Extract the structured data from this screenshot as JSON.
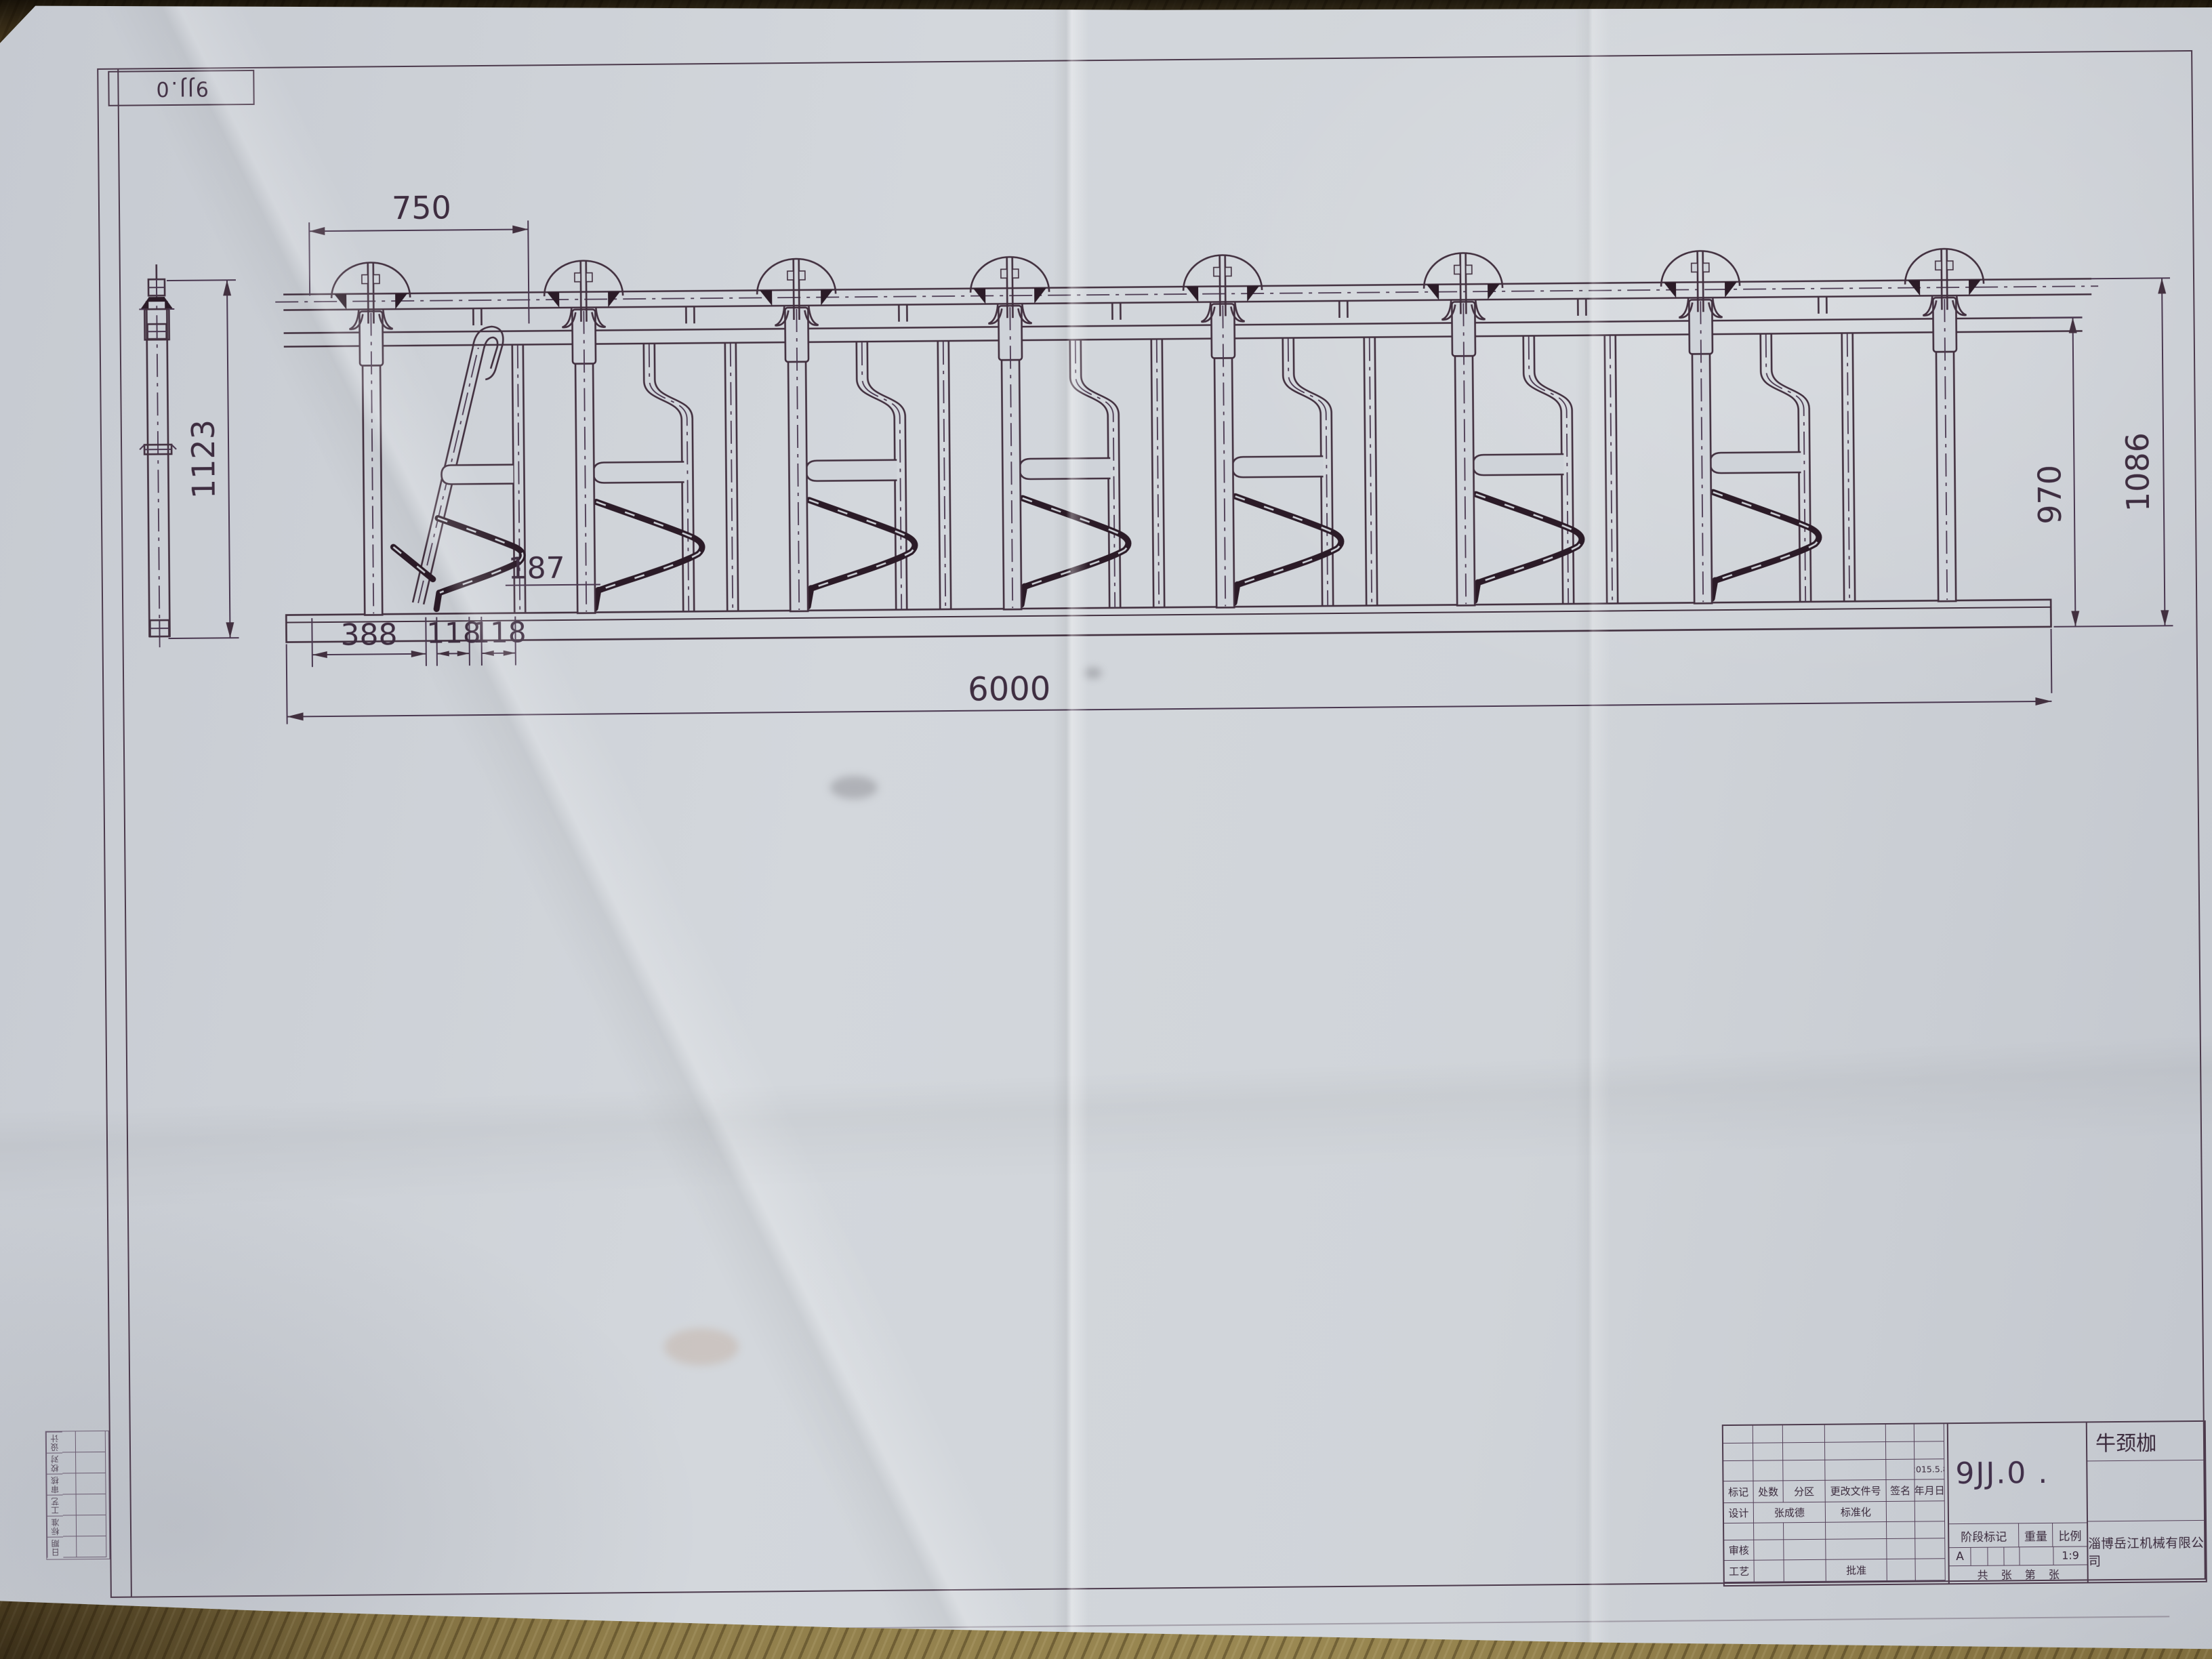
{
  "sheet": {
    "corner_mark": "9JJ.0",
    "paper_color": "#ced2d8",
    "ink_color": "#3f2e3f",
    "wood_color": "#8a7747"
  },
  "dimensions": {
    "bay_width": "750",
    "post_height": "1123",
    "lever_offset": "187",
    "base_seg1": "388",
    "base_seg2": "118",
    "base_seg3": "118",
    "overall_length": "6000",
    "frame_height": "970",
    "overall_height": "1086"
  },
  "title_block": {
    "drawing_number": "9JJ.0 .",
    "part_name": "牛颈枷",
    "company": "淄博岳江机械有限公司",
    "date": "2015.5.8",
    "rev_headers": [
      "标记",
      "处数",
      "分区",
      "更改文件号",
      "签名",
      "年月日"
    ],
    "design_label": "设计",
    "designer_name": "张成德",
    "standardization_label": "标准化",
    "check_label": "审核",
    "process_label": "工艺",
    "approve_label": "批准",
    "stage_label": "阶段标记",
    "weight_label": "重量",
    "scale_label": "比例",
    "stage_value": "A",
    "scale_value": "1:9",
    "sheets_text": "共 张  第 张"
  },
  "margin_table": {
    "labels": [
      "设计",
      "校对",
      "审核",
      "工艺",
      "标准",
      "日期"
    ]
  }
}
